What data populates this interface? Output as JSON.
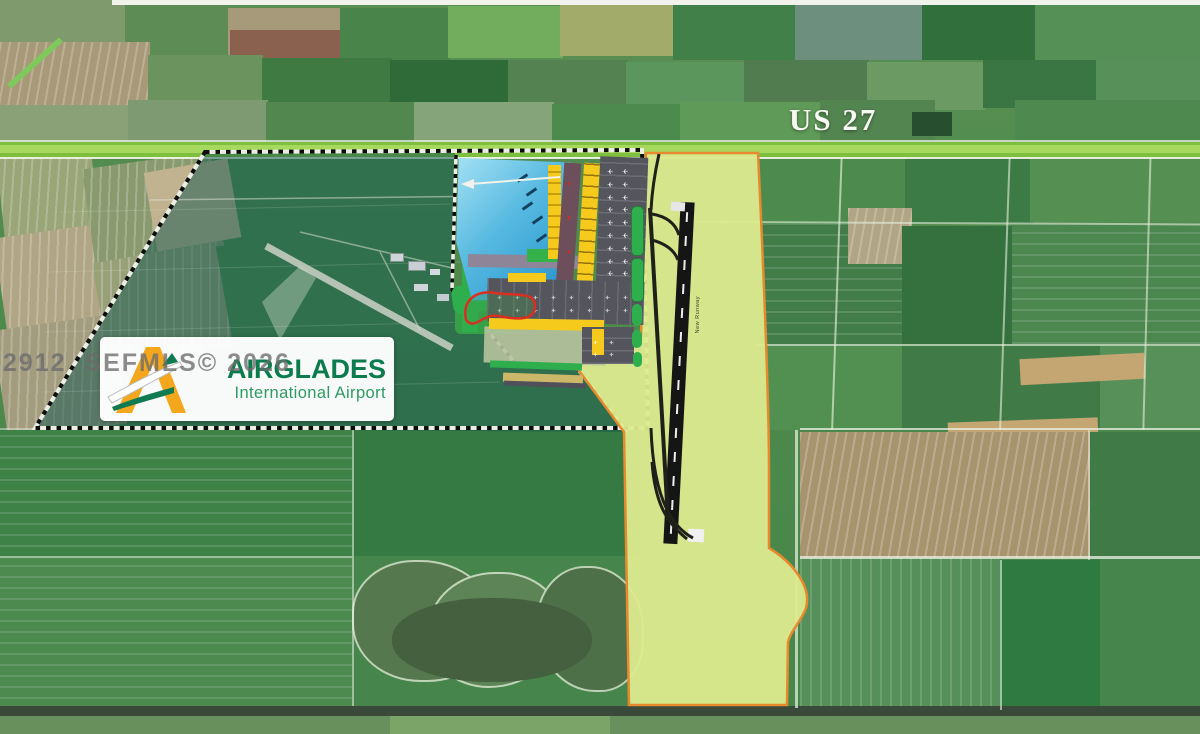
{
  "annotations": {
    "highway_label": "US 27",
    "watermark": "32912  SEFMLS© 2026",
    "runway_label": "New Runway"
  },
  "logo": {
    "title": "AIRGLADES",
    "subtitle": "International Airport",
    "title_color": "#0c7b4d",
    "subtitle_color": "#2d9a63",
    "glyph_yellow": "#F4A71D",
    "glyph_green": "#107B52"
  },
  "colors": {
    "highway_green": "#7fbf3f",
    "highway_light": "#a6d95e",
    "site_overlay_teal": "rgba(21,88,78,0.52)",
    "corridor_fill": "#dcea8e",
    "corridor_outline": "#e78a2e",
    "runway_asphalt": "#151515",
    "plan_building_yellow": "#f6c91d",
    "plan_apron_gray": "#55555e",
    "plan_lake_blue": "#1f8ec9",
    "boundary_dash": "#0d0d0d"
  },
  "paths": {
    "site_teal": "M205,152 L455,153 L452,290 L518,366 L577,368 L627,432 L35,428 Z",
    "site_outline": "M205,152 L642,150 L648,428 L35,428 Z",
    "plan_border": "M456,155 L452,290 L518,366 L577,368 L627,432",
    "corridor": "M646,153 L758,153 C764,280 769,410 769,470 L769,548 C792,562 812,586 806,608 C801,622 791,630 788,642 L787,705 L629,705 L624,432 L577,368 L601,350 L641,336 Z",
    "old_runway": "M266,246 L452,348",
    "old_patch": "M262,302 L300,266 L316,278 L280,340 Z",
    "old_roads": "M150,200 L500,196 M300,232 L452,268 M380,252 L420,330 M470,262 L560,285",
    "faint_rows": "M60,212 L450,204 M50,272 L460,262 M45,332 L470,322 M42,392 L500,382",
    "redloop": "M466,320 C462,300 476,290 495,293 C515,296 536,291 535,307 C534,322 514,319 498,316 C482,313 476,331 466,320",
    "arrow_line": "M560,177 L470,184",
    "arrow_head": "M474,179 L461,184 L474,189 Z",
    "taxiway": "M650,208 L668,520",
    "taxi_links": "M659,154 C655,172 652,190 651,210 M652,214 C664,216 675,222 679,235 M652,240 C663,243 674,249 678,260 M651,428 C653,490 668,525 693,538 M652,462 C655,504 667,523 687,539"
  },
  "scene": {
    "fields": [
      {
        "x": 0,
        "y": 0,
        "w": 125,
        "h": 45,
        "c": "#7f9a6d"
      },
      {
        "x": 125,
        "y": 4,
        "w": 105,
        "h": 52,
        "c": "#5d8d55"
      },
      {
        "x": 228,
        "y": 8,
        "w": 115,
        "h": 48,
        "c": "#a79a7b"
      },
      {
        "x": 230,
        "y": 30,
        "w": 110,
        "h": 30,
        "c": "#8a604f"
      },
      {
        "x": 340,
        "y": 8,
        "w": 110,
        "h": 55,
        "c": "#49854a"
      },
      {
        "x": 448,
        "y": 6,
        "w": 115,
        "h": 52,
        "c": "#71ad5d"
      },
      {
        "x": 560,
        "y": 4,
        "w": 115,
        "h": 52,
        "c": "#a3ab6b"
      },
      {
        "x": 673,
        "y": 4,
        "w": 125,
        "h": 56,
        "c": "#42804a"
      },
      {
        "x": 795,
        "y": 0,
        "w": 130,
        "h": 60,
        "c": "#6d8f7d"
      },
      {
        "x": 922,
        "y": 4,
        "w": 115,
        "h": 56,
        "c": "#31703d"
      },
      {
        "x": 1035,
        "y": 4,
        "w": 165,
        "h": 58,
        "c": "#559056"
      },
      {
        "x": 0,
        "y": 42,
        "w": 150,
        "h": 68,
        "c": "#a89a78",
        "s": "100"
      },
      {
        "x": 148,
        "y": 55,
        "w": 115,
        "h": 52,
        "c": "#6b935e"
      },
      {
        "x": 262,
        "y": 58,
        "w": 130,
        "h": 50,
        "c": "#3f7a42"
      },
      {
        "x": 390,
        "y": 60,
        "w": 120,
        "h": 48,
        "c": "#2f6b38"
      },
      {
        "x": 508,
        "y": 60,
        "w": 120,
        "h": 50,
        "c": "#548251"
      },
      {
        "x": 626,
        "y": 62,
        "w": 120,
        "h": 48,
        "c": "#5b965c"
      },
      {
        "x": 744,
        "y": 60,
        "w": 125,
        "h": 50,
        "c": "#507c50"
      },
      {
        "x": 867,
        "y": 62,
        "w": 118,
        "h": 48,
        "c": "#6b9a62"
      },
      {
        "x": 983,
        "y": 60,
        "w": 115,
        "h": 48,
        "c": "#3a7544"
      },
      {
        "x": 1096,
        "y": 60,
        "w": 104,
        "h": 50,
        "c": "#58905a"
      },
      {
        "x": 0,
        "y": 105,
        "w": 130,
        "h": 38,
        "c": "#8aa077"
      },
      {
        "x": 128,
        "y": 100,
        "w": 140,
        "h": 42,
        "c": "#7d9a72"
      },
      {
        "x": 266,
        "y": 102,
        "w": 150,
        "h": 40,
        "c": "#528850"
      },
      {
        "x": 414,
        "y": 102,
        "w": 140,
        "h": 40,
        "c": "#86a47a"
      },
      {
        "x": 552,
        "y": 104,
        "w": 130,
        "h": 38,
        "c": "#4c8a4e"
      },
      {
        "x": 680,
        "y": 102,
        "w": 140,
        "h": 40,
        "c": "#5f9a58"
      },
      {
        "x": 820,
        "y": 100,
        "w": 115,
        "h": 42,
        "c": "#538551"
      },
      {
        "x": 912,
        "y": 112,
        "w": 40,
        "h": 24,
        "c": "#274f2f"
      },
      {
        "x": 1015,
        "y": 100,
        "w": 185,
        "h": 42,
        "c": "#4e8a50"
      },
      {
        "x": 0,
        "y": 148,
        "w": 95,
        "h": 85,
        "c": "#9aa578",
        "r": -6,
        "s": "100"
      },
      {
        "x": 0,
        "y": 230,
        "w": 115,
        "h": 95,
        "c": "#b0a585",
        "r": -8,
        "s": "100"
      },
      {
        "x": 0,
        "y": 322,
        "w": 120,
        "h": 110,
        "c": "#a39c7e",
        "r": -8,
        "s": "100"
      },
      {
        "x": 88,
        "y": 160,
        "w": 130,
        "h": 95,
        "c": "#8a9a6f",
        "r": -8,
        "s": "100"
      },
      {
        "x": 100,
        "y": 252,
        "w": 125,
        "h": 105,
        "c": "#98a078",
        "r": -10,
        "s": "100"
      },
      {
        "x": 150,
        "y": 165,
        "w": 85,
        "h": 80,
        "c": "#c2b390",
        "r": -10
      },
      {
        "x": 758,
        "y": 152,
        "w": 150,
        "h": 72,
        "c": "#4c8a4e"
      },
      {
        "x": 905,
        "y": 152,
        "w": 128,
        "h": 72,
        "c": "#3c7a46"
      },
      {
        "x": 1030,
        "y": 150,
        "w": 170,
        "h": 72,
        "c": "#559052"
      },
      {
        "x": 760,
        "y": 224,
        "w": 142,
        "h": 122,
        "c": "#427c49",
        "s": "0"
      },
      {
        "x": 848,
        "y": 208,
        "w": 64,
        "h": 56,
        "c": "#b0a585",
        "s": "100"
      },
      {
        "x": 902,
        "y": 226,
        "w": 110,
        "h": 118,
        "c": "#35703f"
      },
      {
        "x": 1012,
        "y": 224,
        "w": 188,
        "h": 120,
        "c": "#4c8750",
        "s": "0"
      },
      {
        "x": 760,
        "y": 346,
        "w": 142,
        "h": 84,
        "c": "#529052"
      },
      {
        "x": 902,
        "y": 346,
        "w": 200,
        "h": 84,
        "c": "#3f7a47"
      },
      {
        "x": 1100,
        "y": 344,
        "w": 100,
        "h": 86,
        "c": "#58905a"
      },
      {
        "x": 1020,
        "y": 356,
        "w": 125,
        "h": 26,
        "c": "#c4a672",
        "r": -3
      },
      {
        "x": 948,
        "y": 420,
        "w": 150,
        "h": 22,
        "c": "#c4a672",
        "r": -2
      },
      {
        "x": 800,
        "y": 432,
        "w": 292,
        "h": 126,
        "c": "#a8936f",
        "s": "100"
      },
      {
        "x": 1090,
        "y": 432,
        "w": 110,
        "h": 128,
        "c": "#3f7a47"
      },
      {
        "x": 800,
        "y": 558,
        "w": 200,
        "h": 152,
        "c": "#55905a",
        "s": "90"
      },
      {
        "x": 1000,
        "y": 560,
        "w": 200,
        "h": 150,
        "c": "#2e7a40"
      },
      {
        "x": 1100,
        "y": 558,
        "w": 100,
        "h": 150,
        "c": "#46854c"
      },
      {
        "x": 0,
        "y": 430,
        "w": 352,
        "h": 128,
        "c": "#3f8248",
        "s": "0"
      },
      {
        "x": 0,
        "y": 556,
        "w": 352,
        "h": 154,
        "c": "#4c8a50",
        "s": "0"
      },
      {
        "x": 352,
        "y": 430,
        "w": 288,
        "h": 128,
        "c": "#357a42"
      },
      {
        "x": 352,
        "y": 556,
        "w": 290,
        "h": 154,
        "c": "#46854c"
      },
      {
        "x": 352,
        "y": 560,
        "w": 140,
        "h": 118,
        "c": "#56784e",
        "br": "45% 55% 50% 50%",
        "bd": 2
      },
      {
        "x": 428,
        "y": 572,
        "w": 130,
        "h": 112,
        "c": "#5d8457",
        "br": "50% 45% 55% 45%",
        "bd": 2
      },
      {
        "x": 536,
        "y": 566,
        "w": 104,
        "h": 122,
        "c": "#4e7048",
        "br": "45% 50% 40% 55%",
        "bd": 2
      },
      {
        "x": 392,
        "y": 598,
        "w": 200,
        "h": 84,
        "c": "#44603f",
        "br": "48%"
      },
      {
        "x": 0,
        "y": 706,
        "w": 1200,
        "h": 12,
        "c": "#3a4a3a"
      },
      {
        "x": 0,
        "y": 716,
        "w": 1200,
        "h": 18,
        "c": "#68905c"
      },
      {
        "x": 390,
        "y": 716,
        "w": 220,
        "h": 18,
        "c": "#7aa468"
      }
    ],
    "roads": [
      {
        "x": 112,
        "y": 0,
        "w": 1088,
        "h": 5,
        "c": "#f2f2ec"
      },
      {
        "x": 0,
        "y": 60,
        "w": 70,
        "h": 6,
        "c": "#7ec85c",
        "r": -42
      },
      {
        "x": 836,
        "y": 150,
        "w": 2,
        "h": 280,
        "c": "rgba(230,240,220,.65)",
        "r": 2
      },
      {
        "x": 1004,
        "y": 150,
        "w": 2,
        "h": 280,
        "c": "rgba(230,240,220,.6)",
        "r": 2
      },
      {
        "x": 1146,
        "y": 150,
        "w": 2,
        "h": 280,
        "c": "rgba(230,240,220,.6)",
        "r": 1.5
      },
      {
        "x": 795,
        "y": 430,
        "w": 3,
        "h": 278,
        "c": "rgba(235,242,228,.7)"
      },
      {
        "x": 1000,
        "y": 560,
        "w": 2,
        "h": 150,
        "c": "rgba(235,242,228,.6)"
      },
      {
        "x": 1088,
        "y": 430,
        "w": 2,
        "h": 130,
        "c": "rgba(235,242,228,.55)"
      },
      {
        "x": 352,
        "y": 430,
        "w": 2,
        "h": 276,
        "c": "rgba(235,242,228,.55)"
      },
      {
        "x": 648,
        "y": 222,
        "w": 552,
        "h": 2,
        "c": "rgba(230,240,220,.6)",
        "r": 0.3
      },
      {
        "x": 756,
        "y": 344,
        "w": 444,
        "h": 2,
        "c": "rgba(230,240,220,.6)"
      },
      {
        "x": 800,
        "y": 428,
        "w": 400,
        "h": 2,
        "c": "rgba(235,242,228,.75)"
      },
      {
        "x": 800,
        "y": 556,
        "w": 400,
        "h": 3,
        "c": "rgba(235,242,228,.75)"
      },
      {
        "x": 0,
        "y": 556,
        "w": 352,
        "h": 2,
        "c": "rgba(235,242,228,.5)"
      },
      {
        "x": 0,
        "y": 428,
        "w": 210,
        "h": 2,
        "c": "rgba(235,242,228,.45)"
      },
      {
        "x": 0,
        "y": 140,
        "w": 1200,
        "h": 2,
        "c": "rgba(245,250,240,.7)"
      },
      {
        "x": 0,
        "y": 142,
        "w": 1200,
        "h": 16,
        "c": "#7fbf3f"
      },
      {
        "x": 0,
        "y": 145,
        "w": 1200,
        "h": 8,
        "c": "#a6d95e"
      },
      {
        "x": 0,
        "y": 157,
        "w": 1200,
        "h": 2,
        "c": "rgba(250,250,245,.85)"
      }
    ],
    "plan_blocks": [
      {
        "x": 390,
        "y": 253,
        "w": 12,
        "h": 7,
        "c": "#cfd6da",
        "bd": 1,
        "n": "old-airport-building"
      },
      {
        "x": 408,
        "y": 261,
        "w": 16,
        "h": 8,
        "c": "#c8d0d6",
        "bd": 1,
        "n": "old-airport-building"
      },
      {
        "x": 430,
        "y": 269,
        "w": 10,
        "h": 6,
        "c": "#d4dade",
        "n": "old-airport-building"
      },
      {
        "x": 414,
        "y": 284,
        "w": 14,
        "h": 7,
        "c": "#cfd6da",
        "n": "old-airport-building"
      },
      {
        "x": 437,
        "y": 294,
        "w": 12,
        "h": 7,
        "c": "#c4ccd2",
        "n": "old-airport-building"
      },
      {
        "x": 455,
        "y": 300,
        "w": 62,
        "h": 34,
        "c": "#35a048",
        "br": 6,
        "n": "plan-green-area"
      },
      {
        "x": 452,
        "y": 282,
        "w": 72,
        "h": 28,
        "c": "#2fae4e",
        "r": -8,
        "br": 8,
        "n": "plan-green-area"
      },
      {
        "x": 462,
        "y": 258,
        "w": 16,
        "h": 74,
        "c": "#2fae4e",
        "n": "plan-green-buffer"
      },
      {
        "x": 455,
        "y": 155,
        "w": 122,
        "h": 150,
        "g": 1,
        "clip": "3% 2%, 95% 5%, 99% 52%, 76% 96%, 14% 97%, 1% 58%",
        "n": "plan-lake"
      },
      {
        "x": 521,
        "y": 172,
        "w": 3,
        "h": 12,
        "c": "#14405e",
        "r": 55,
        "n": "plan-annotation-mark"
      },
      {
        "x": 530,
        "y": 186,
        "w": 3,
        "h": 12,
        "c": "#14405e",
        "r": 55,
        "n": "plan-annotation-mark"
      },
      {
        "x": 526,
        "y": 200,
        "w": 3,
        "h": 12,
        "c": "#14405e",
        "r": 55,
        "n": "plan-annotation-mark"
      },
      {
        "x": 536,
        "y": 214,
        "w": 3,
        "h": 12,
        "c": "#14405e",
        "r": 55,
        "n": "plan-annotation-mark"
      },
      {
        "x": 540,
        "y": 232,
        "w": 3,
        "h": 12,
        "c": "#14405e",
        "r": 55,
        "n": "plan-annotation-mark"
      },
      {
        "x": 533,
        "y": 250,
        "w": 3,
        "h": 12,
        "c": "#14405e",
        "r": 55,
        "n": "plan-annotation-mark"
      },
      {
        "x": 468,
        "y": 255,
        "w": 120,
        "h": 13,
        "c": "#8f8598",
        "r": 1,
        "n": "plan-road"
      },
      {
        "x": 527,
        "y": 249,
        "w": 48,
        "h": 13,
        "c": "#35b14a",
        "n": "plan-green-area"
      },
      {
        "x": 548,
        "y": 165,
        "w": 13,
        "h": 94,
        "s": "y",
        "n": "plan-building-row"
      },
      {
        "x": 560,
        "y": 163,
        "w": 17,
        "h": 124,
        "c": "#6d4f5c",
        "r": 4,
        "n": "plan-road"
      },
      {
        "x": 580,
        "y": 163,
        "w": 16,
        "h": 134,
        "c": "#f6c91d",
        "r": 3.5,
        "s": "t",
        "n": "plan-cargo-building"
      },
      {
        "x": 598,
        "y": 157,
        "w": 48,
        "h": 132,
        "c": "#55555e",
        "r": 2,
        "s": "row",
        "n": "plan-cargo-apron"
      },
      {
        "x": 484,
        "y": 328,
        "w": 122,
        "h": 36,
        "c": "#b6c29e",
        "r": 1.5,
        "o": 0.9,
        "n": "plan-ground"
      },
      {
        "x": 487,
        "y": 280,
        "w": 157,
        "h": 43,
        "c": "#55555e",
        "r": 1.5,
        "s": "col",
        "n": "plan-ga-apron"
      },
      {
        "x": 508,
        "y": 273,
        "w": 38,
        "h": 9,
        "c": "#f6c91d",
        "n": "plan-building"
      },
      {
        "x": 489,
        "y": 319,
        "w": 115,
        "h": 11,
        "c": "#f6c91d",
        "r": 1,
        "n": "plan-building"
      },
      {
        "x": 582,
        "y": 327,
        "w": 52,
        "h": 37,
        "c": "#55555e",
        "s": "row",
        "n": "plan-ga-apron"
      },
      {
        "x": 592,
        "y": 329,
        "w": 12,
        "h": 26,
        "c": "#f6c91d",
        "n": "plan-building"
      },
      {
        "x": 490,
        "y": 362,
        "w": 92,
        "h": 7,
        "c": "#2fae4e",
        "r": 2,
        "n": "plan-green-strip"
      },
      {
        "x": 503,
        "y": 374,
        "w": 80,
        "h": 9,
        "c": "#cdb768",
        "r": 2,
        "n": "plan-strip"
      },
      {
        "x": 504,
        "y": 382,
        "w": 82,
        "h": 5,
        "c": "#50505a",
        "r": 2,
        "n": "plan-strip"
      },
      {
        "x": 631,
        "y": 206,
        "w": 11,
        "h": 48,
        "c": "#2fae4e",
        "br": 5,
        "bd": 1,
        "n": "taxiway-pad"
      },
      {
        "x": 631,
        "y": 258,
        "w": 11,
        "h": 42,
        "c": "#2fae4e",
        "br": 5,
        "bd": 1,
        "n": "taxiway-pad"
      },
      {
        "x": 632,
        "y": 304,
        "w": 10,
        "h": 22,
        "c": "#2fae4e",
        "br": 8,
        "n": "taxiway-pad"
      },
      {
        "x": 632,
        "y": 330,
        "w": 10,
        "h": 18,
        "c": "#2fae4e",
        "br": 8,
        "n": "taxiway-pad"
      },
      {
        "x": 633,
        "y": 352,
        "w": 9,
        "h": 15,
        "c": "#2fae4e",
        "br": 7,
        "n": "taxiway-pad"
      },
      {
        "x": 672,
        "y": 202,
        "w": 14,
        "h": 342,
        "c": "#151515",
        "r": 2.9,
        "n": "new-runway"
      },
      {
        "x": 678,
        "y": 212,
        "w": 2,
        "h": 322,
        "s": "dash",
        "r": 2.9,
        "n": "runway-centerline"
      },
      {
        "x": 671,
        "y": 202,
        "w": 14,
        "h": 9,
        "c": "#e6e6e6",
        "r": 2.9,
        "n": "runway-threshold"
      },
      {
        "x": 688,
        "y": 529,
        "w": 16,
        "h": 13,
        "c": "#f0f0f0",
        "r": 3,
        "n": "runway-threshold"
      }
    ],
    "glyphs": [
      {
        "ch": "✈",
        "x": 607,
        "y": 167,
        "cols": 2,
        "rows": 9,
        "dx": 15,
        "dy": 12.8,
        "size": 7,
        "c": "#ffffff",
        "rot": 180,
        "n": "aircraft-icon"
      },
      {
        "ch": "✈",
        "x": 497,
        "y": 293,
        "cols": 8,
        "rows": 2,
        "dx": 18,
        "dy": 13,
        "size": 5.5,
        "c": "#ffffff",
        "rot": 180,
        "n": "aircraft-icon"
      },
      {
        "ch": "✈",
        "x": 593,
        "y": 338,
        "cols": 2,
        "rows": 2,
        "dx": 16,
        "dy": 12,
        "size": 5.5,
        "c": "#ffffff",
        "rot": 180,
        "n": "aircraft-icon"
      },
      {
        "ch": "▼",
        "x": 566,
        "y": 182,
        "cols": 1,
        "rows": 3,
        "dx": 0,
        "dy": 34,
        "size": 6,
        "c": "#e02818",
        "rot": 0,
        "n": "red-arrow-icon"
      }
    ]
  }
}
